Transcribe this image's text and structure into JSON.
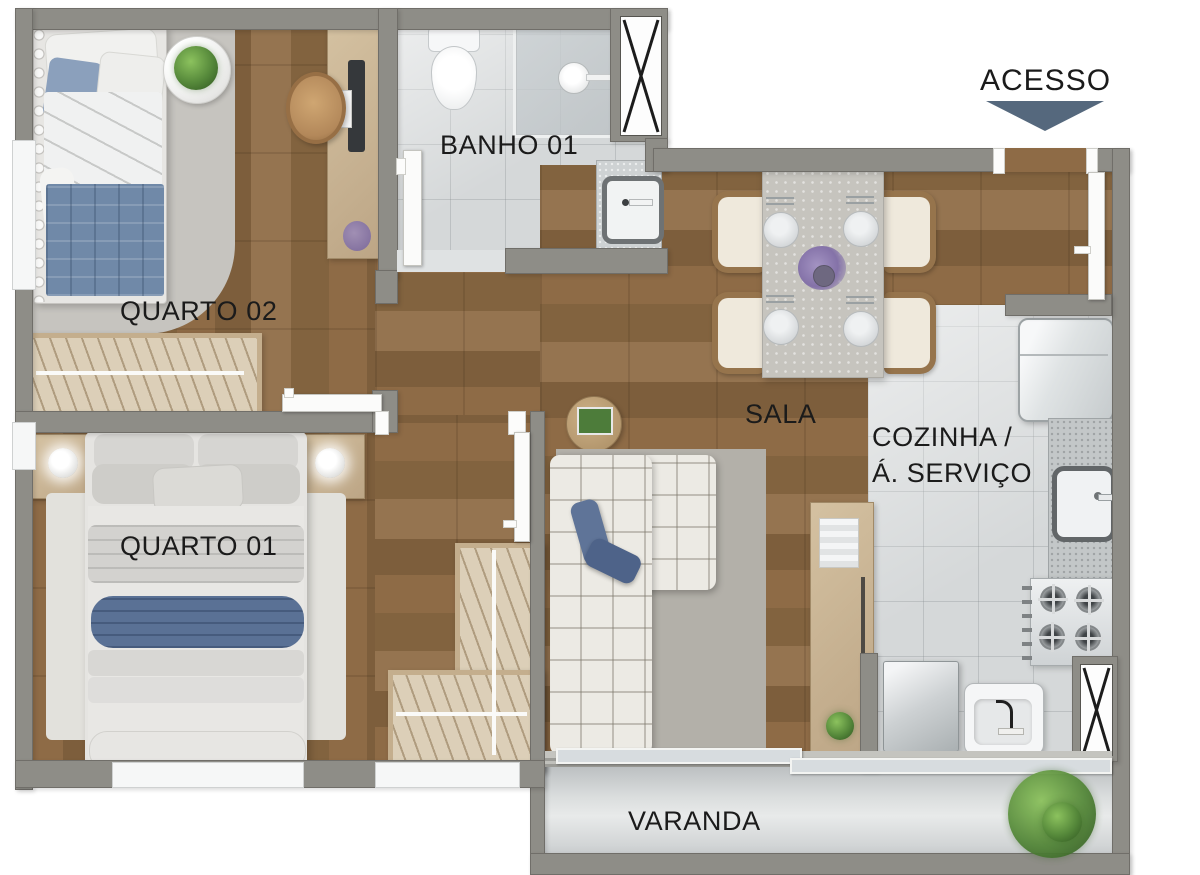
{
  "plan": {
    "name": "apartment-floor-plan",
    "labels": {
      "acesso": "ACESSO",
      "quarto02": "QUARTO 02",
      "banho01": "BANHO 01",
      "sala": "SALA",
      "cozinha_line1": "COZINHA /",
      "cozinha_line2": "Á. SERVIÇO",
      "quarto01": "QUARTO 01",
      "varanda": "VARANDA"
    },
    "colors": {
      "wall": "#8e8d87",
      "wood_floor": "#876543",
      "tile_floor": "#d5d8d9",
      "varanda_floor": "#dadddd",
      "access_arrow": "#55687d",
      "textile_blue": "#5a7195",
      "label_text": "#1b1b1b"
    },
    "icons": {
      "access_arrow": "triangle-down",
      "shaft": "x-cross"
    }
  }
}
